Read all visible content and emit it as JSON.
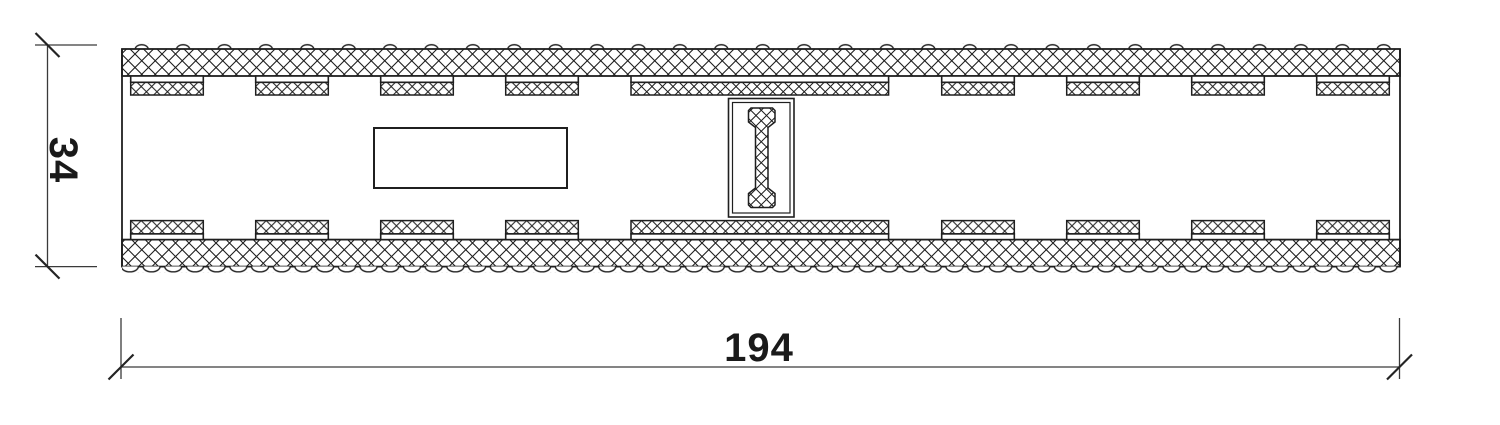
{
  "drawing": {
    "dimensions": {
      "height_label": "34",
      "width_label": "194"
    },
    "colors": {
      "line": "#1f1f1f",
      "dimension_line": "#3a3a3a",
      "text": "#1a1a1a",
      "background": "#ffffff"
    }
  }
}
